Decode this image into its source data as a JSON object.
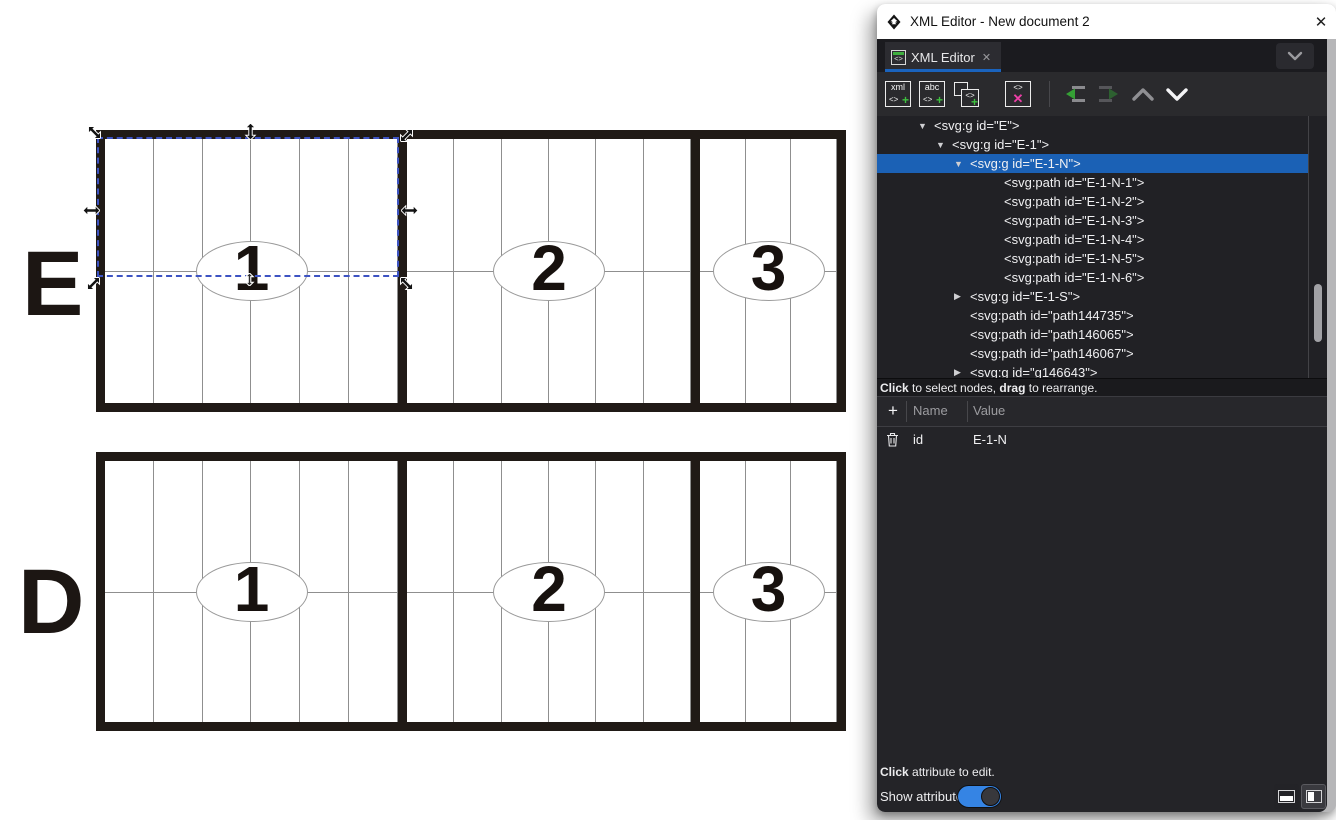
{
  "window": {
    "title": "XML Editor - New document 2",
    "close_glyph": "✕"
  },
  "tab_bar": {
    "tab_label": "XML Editor",
    "tab_close_glyph": "✕",
    "tab_icon_tag": "<>"
  },
  "toolbar": {
    "new_element": {
      "line1": "xml",
      "tag": "<>",
      "plus": "+"
    },
    "new_text": {
      "line1": "abc",
      "tag": "<>",
      "plus": "+"
    },
    "duplicate": {
      "tag": "<>",
      "plus": "+"
    },
    "delete": {
      "tag": "<>",
      "x": "✕"
    }
  },
  "tree": {
    "rows": [
      {
        "expander": "▼",
        "text": "<svg:g id=\"E\">",
        "selected": false
      },
      {
        "expander": "▼",
        "text": "<svg:g id=\"E-1\">",
        "selected": false
      },
      {
        "expander": "▼",
        "text": "<svg:g id=\"E-1-N\">",
        "selected": true
      },
      {
        "expander": "",
        "text": "<svg:path id=\"E-1-N-1\">",
        "selected": false
      },
      {
        "expander": "",
        "text": "<svg:path id=\"E-1-N-2\">",
        "selected": false
      },
      {
        "expander": "",
        "text": "<svg:path id=\"E-1-N-3\">",
        "selected": false
      },
      {
        "expander": "",
        "text": "<svg:path id=\"E-1-N-4\">",
        "selected": false
      },
      {
        "expander": "",
        "text": "<svg:path id=\"E-1-N-5\">",
        "selected": false
      },
      {
        "expander": "",
        "text": "<svg:path id=\"E-1-N-6\">",
        "selected": false
      },
      {
        "expander": "▶",
        "text": "<svg:g id=\"E-1-S\">",
        "selected": false
      },
      {
        "expander": "",
        "text": "<svg:path id=\"path144735\">",
        "selected": false
      },
      {
        "expander": "",
        "text": "<svg:path id=\"path146065\">",
        "selected": false
      },
      {
        "expander": "",
        "text": "<svg:path id=\"path146067\">",
        "selected": false
      },
      {
        "expander": "▶",
        "text": "<svg:g id=\"g146643\">",
        "selected": false
      }
    ],
    "hint": {
      "bold1": "Click",
      "text1": " to select nodes, ",
      "bold2": "drag",
      "text2": " to rearrange."
    }
  },
  "attributes": {
    "add_glyph": "+",
    "headers": {
      "name": "Name",
      "value": "Value"
    },
    "rows": [
      {
        "name": "id",
        "value": "E-1-N"
      }
    ],
    "hint": {
      "bold": "Click",
      "text": " attribute to edit."
    },
    "show_attributes_label": "Show attributes",
    "toggle_on": true
  },
  "canvas": {
    "rows": [
      {
        "label": "E",
        "sections": [
          {
            "number": "1"
          },
          {
            "number": "2"
          },
          {
            "number": "3"
          }
        ]
      },
      {
        "label": "D",
        "sections": [
          {
            "number": "1"
          },
          {
            "number": "2"
          },
          {
            "number": "3"
          }
        ]
      }
    ]
  },
  "colors": {
    "selection_blue": "#1b61b5",
    "accent_blue": "#1a63bd",
    "toggle_blue": "#3584e4",
    "icon_green": "#3fc03f",
    "icon_magenta": "#ee3fa8"
  }
}
